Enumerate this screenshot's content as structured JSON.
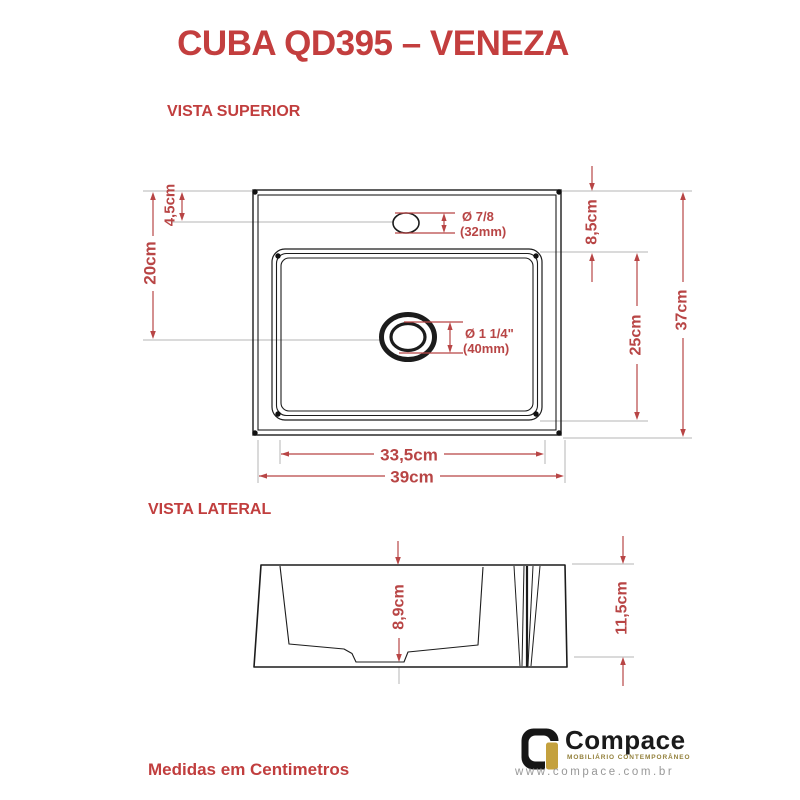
{
  "title": "CUBA QD395 – VENEZA",
  "sections": {
    "top": "VISTA SUPERIOR",
    "side": "VISTA LATERAL"
  },
  "top_view": {
    "dim_top_offset": "4,5cm",
    "dim_left_height": "20cm",
    "dim_rim_offset": "8,5cm",
    "dim_basin_height": "25cm",
    "dim_total_height": "37cm",
    "dim_basin_width": "33,5cm",
    "dim_total_width": "39cm",
    "faucet_diameter": "Ø 7/8",
    "faucet_diameter_mm": "(32mm)",
    "drain_diameter": "Ø 1 1/4\"",
    "drain_diameter_mm": "(40mm)"
  },
  "side_view": {
    "dim_depth": "8,9cm",
    "dim_total_height": "11,5cm"
  },
  "footer_note": "Medidas em Centimetros",
  "brand": {
    "name": "Compace",
    "tagline": "MOBILIÁRIO CONTEMPORÂNEO",
    "website": "www.compace.com.br"
  },
  "colors": {
    "dimension_red": "#b84545",
    "heading_red": "#c33e3e",
    "line_black": "#1c1c1c",
    "extension_gray": "#b5b5b5",
    "brand_gold": "#c4a13e"
  }
}
